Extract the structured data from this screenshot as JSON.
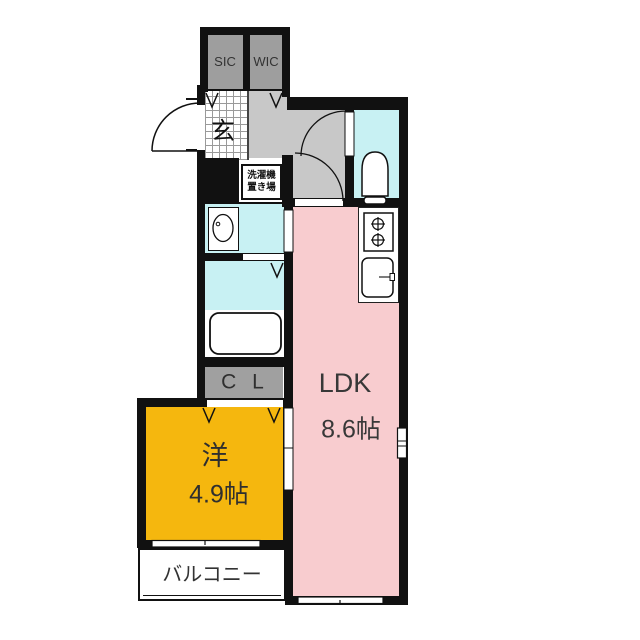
{
  "floorplan": {
    "title": "1LDK apartment floor plan",
    "rooms": {
      "ldk": {
        "name": "LDK",
        "size": "8.6帖",
        "color": "#f8cccf"
      },
      "western": {
        "name": "洋",
        "size": "4.9帖",
        "color": "#f5b70e"
      },
      "genkan": {
        "name": "玄"
      },
      "sic": {
        "name": "SIC",
        "color": "#9e9e9e"
      },
      "wic": {
        "name": "WIC",
        "color": "#9e9e9e"
      },
      "cl": {
        "name": "C L",
        "color": "#a0a0a0"
      },
      "balcony": {
        "name": "バルコニー"
      },
      "laundry": {
        "line1": "洗濯機",
        "line2": "置き場"
      },
      "toilet": {
        "color": "#c8f1f3"
      },
      "washroom": {
        "color": "#c8f1f3"
      },
      "bathroom": {
        "color": "#c8f1f3"
      },
      "hallway": {
        "color": "#c8c8c8"
      }
    },
    "wall_color": "#111111",
    "fixtures": [
      "bathtub",
      "toilet",
      "washbasin",
      "stove-2-burner",
      "kitchen-sink",
      "washing-machine-space"
    ]
  }
}
